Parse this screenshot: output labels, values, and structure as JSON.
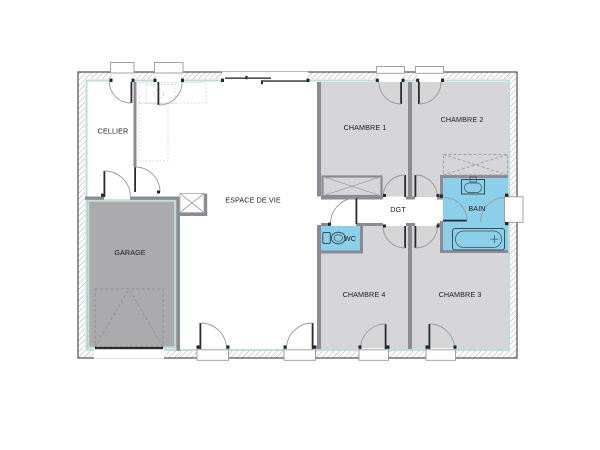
{
  "plan": {
    "type": "floor-plan",
    "rooms": {
      "cellier": {
        "label": "CELLIER"
      },
      "garage": {
        "label": "GARAGE"
      },
      "living": {
        "label": "ESPACE DE VIE"
      },
      "bedroom1": {
        "label": "CHAMBRE 1"
      },
      "bedroom2": {
        "label": "CHAMBRE 2"
      },
      "bedroom3": {
        "label": "CHAMBRE 3"
      },
      "bedroom4": {
        "label": "CHAMBRE 4"
      },
      "hallway": {
        "label": "DGT"
      },
      "bathroom": {
        "label": "BAIN"
      },
      "wc": {
        "label": "WC"
      }
    }
  },
  "colors": {
    "bedroom_fill": "#d6d6d8",
    "garage_fill": "#ababad",
    "wet_room_fill": "#8ccfeb",
    "wall_interior": "#8b8b94",
    "wall_outline": "#3f3f46",
    "insulation_line": "#bcdfd7",
    "text": "#1c1c1c"
  }
}
